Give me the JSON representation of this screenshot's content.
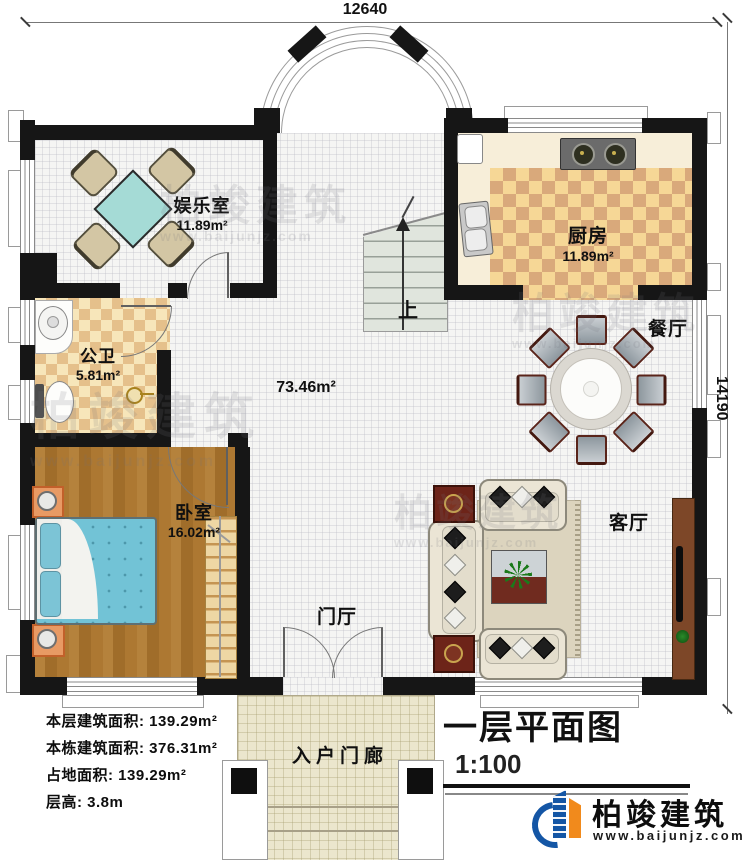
{
  "dimensions": {
    "top": "12640",
    "right": "14190"
  },
  "rooms": {
    "entertainment": {
      "name": "娱乐室",
      "area": "11.89m²"
    },
    "kitchen": {
      "name": "厨房",
      "area": "11.89m²"
    },
    "bathroom": {
      "name": "公卫",
      "area": "5.81m²"
    },
    "bedroom": {
      "name": "卧室",
      "area": "16.02m²"
    },
    "dining": {
      "name": "餐厅"
    },
    "living": {
      "name": "客厅"
    },
    "foyer": {
      "name": "门厅"
    },
    "porch": {
      "name": "入户门廊"
    },
    "hall": {
      "area": "73.46m²"
    },
    "stairs": {
      "label": "上"
    }
  },
  "info": {
    "floor_area": {
      "label": "本层建筑面积:",
      "value": "139.29m²"
    },
    "total_area": {
      "label": "本栋建筑面积:",
      "value": "376.31m²"
    },
    "land_area": {
      "label": "占地面积:",
      "value": "139.29m²"
    },
    "height": {
      "label": "层高:",
      "value": "3.8m"
    }
  },
  "title": {
    "text": "一层平面图",
    "scale": "1:100"
  },
  "logo": {
    "name": "柏竣建筑",
    "url": "www.baijunjz.com"
  },
  "watermark": {
    "text": "柏竣建筑",
    "url": "www.baijunjz.com"
  },
  "colors": {
    "wall": "#161616",
    "kitchen_checker_dark": "#d9a97b",
    "kitchen_checker_light": "#f6d796",
    "bath_checker_dark": "#e5c08b",
    "bath_checker_light": "#f7e6ba",
    "wood_floor": "#a9772f",
    "bed_teal": "#72c3d6",
    "logo_blue": "#1456a5",
    "logo_orange": "#f18a1c"
  }
}
